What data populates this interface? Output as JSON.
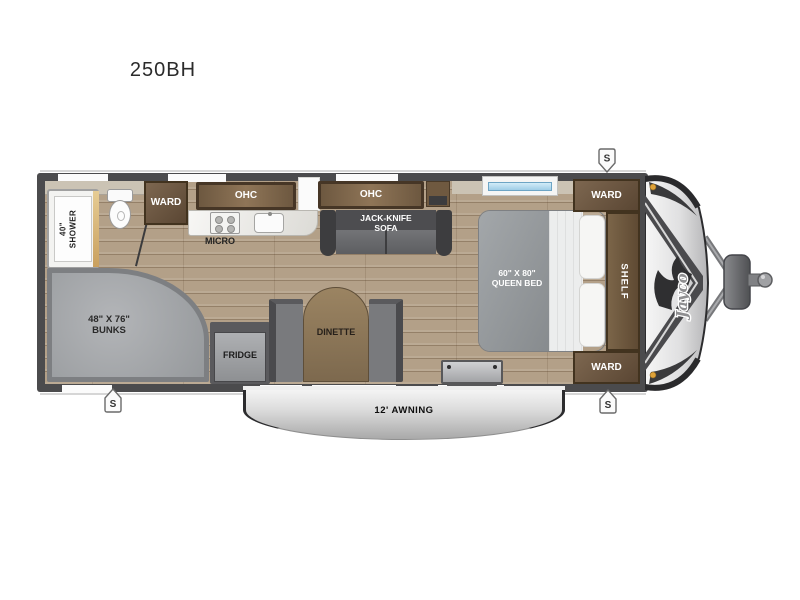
{
  "title": "250BH",
  "colors": {
    "floor_wood": "#b3a088",
    "wall": "#4b4b4d",
    "cabinet_brown": "#6d5840",
    "upholstery_gray": "#797a7d",
    "awning_silver": "#c9c9c9",
    "marker_amber": "#dfa238"
  },
  "floorplan": {
    "bathroom": {
      "shower_line1": "40\"",
      "shower_line2": "SHOWER"
    },
    "kitchen": {
      "ward": "WARD",
      "ohc": "OHC",
      "micro": "MICRO",
      "fridge": "FRIDGE"
    },
    "living": {
      "ohc": "OHC",
      "sofa_line1": "JACK-KNIFE",
      "sofa_line2": "SOFA",
      "dinette": "DINETTE"
    },
    "bunk_room": {
      "size": "48\" X 76\"",
      "label": "BUNKS"
    },
    "bedroom": {
      "bed_size": "60\" X 80\"",
      "bed_label": "QUEEN BED",
      "ward_front": "WARD",
      "shelf": "SHELF",
      "ward_rear": "WARD"
    },
    "exterior": {
      "awning": "12' AWNING",
      "speaker_marker": "S",
      "brand": "Jayco"
    }
  }
}
